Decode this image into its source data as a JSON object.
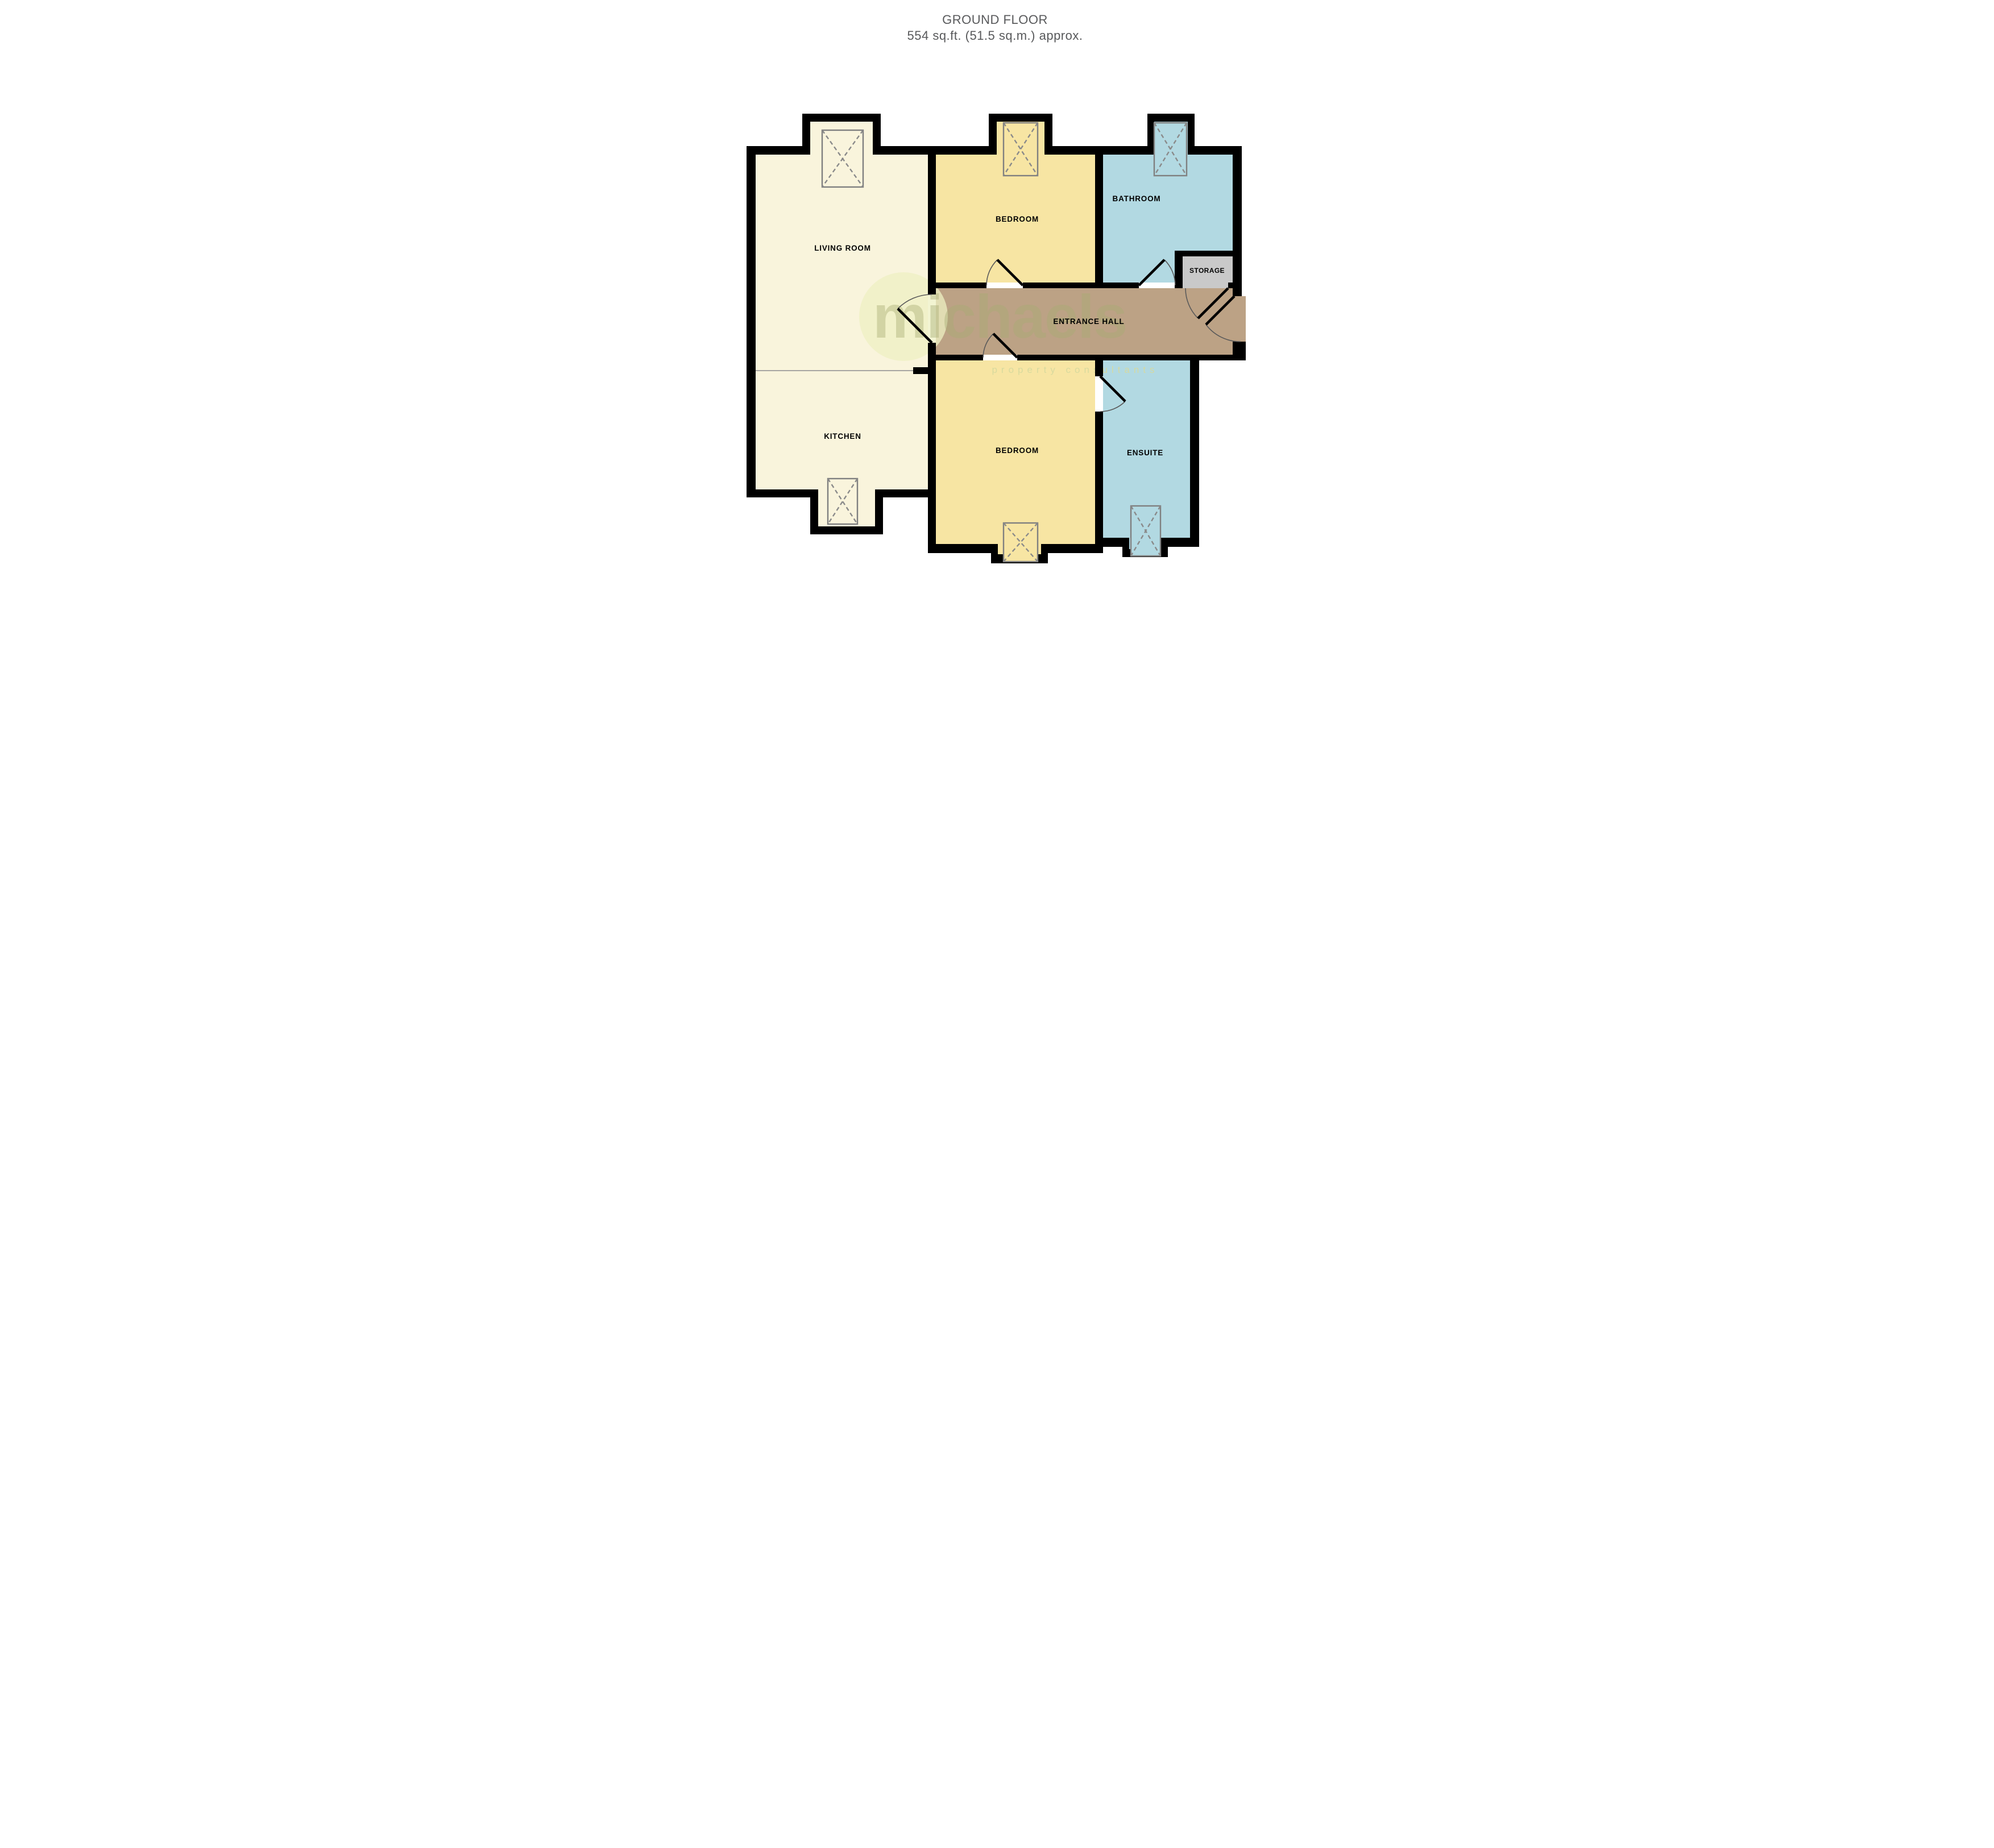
{
  "title": {
    "line1": "GROUND FLOOR",
    "line2": "554 sq.ft. (51.5 sq.m.) approx."
  },
  "watermark": {
    "brand": "michaels",
    "tagline": "property consultants"
  },
  "rooms": [
    {
      "id": "living-room",
      "label": "LIVING ROOM",
      "color": "#f9f4dc"
    },
    {
      "id": "kitchen",
      "label": "KITCHEN",
      "color": "#f9f4dc"
    },
    {
      "id": "bedroom-top",
      "label": "BEDROOM",
      "color": "#f7e5a3"
    },
    {
      "id": "bathroom",
      "label": "BATHROOM",
      "color": "#b2d9e2"
    },
    {
      "id": "storage",
      "label": "STORAGE",
      "color": "#c9c9c9"
    },
    {
      "id": "entrance-hall",
      "label": "ENTRANCE HALL",
      "color": "#bca285"
    },
    {
      "id": "bedroom-bottom",
      "label": "BEDROOM",
      "color": "#f7e5a3"
    },
    {
      "id": "ensuite",
      "label": "ENSUITE",
      "color": "#b2d9e2"
    }
  ],
  "colors": {
    "wall": "#000000",
    "window_frame": "#7f7f7f",
    "door_arc": "#5a5a5a",
    "title_text": "#58595b",
    "watermark_brand": "#a8ac72",
    "watermark_tagline": "#d6d99e",
    "background": "#ffffff"
  }
}
